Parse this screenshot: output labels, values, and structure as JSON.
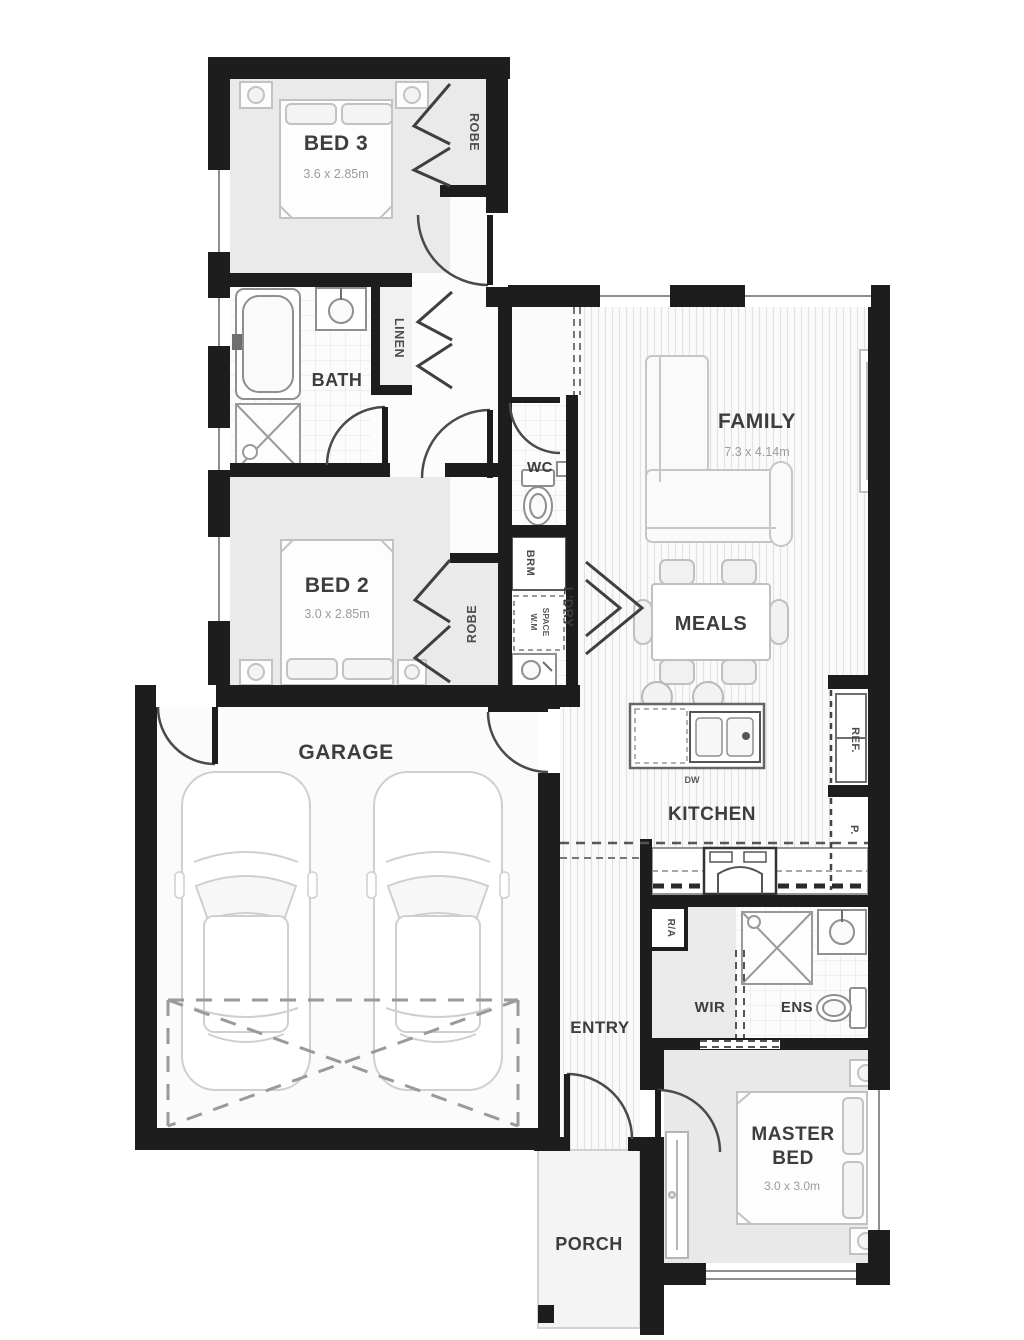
{
  "plan": {
    "rooms": {
      "bed3": {
        "name": "BED 3",
        "dims": "3.6 x 2.85m"
      },
      "bed2": {
        "name": "BED 2",
        "dims": "3.0 x 2.85m"
      },
      "master": {
        "line1": "MASTER",
        "line2": "BED",
        "dims": "3.0 x 3.0m"
      },
      "family": {
        "name": "FAMILY",
        "dims": "7.3 x 4.14m"
      },
      "meals": {
        "name": "MEALS"
      },
      "kitchen": {
        "name": "KITCHEN"
      },
      "garage": {
        "name": "GARAGE"
      },
      "bath": {
        "name": "BATH"
      },
      "wc": {
        "name": "WC"
      },
      "ldry": {
        "name": "L'DRY"
      },
      "entry": {
        "name": "ENTRY"
      },
      "porch": {
        "name": "PORCH"
      },
      "wir": {
        "name": "WIR"
      },
      "ens": {
        "name": "ENS"
      }
    },
    "storage": {
      "robe_bed3": "ROBE",
      "robe_bed2": "ROBE",
      "linen": "LINEN",
      "brm": "BRM",
      "wm_line1": "W.M",
      "wm_line2": "SPACE",
      "ref": "REF.",
      "pantry": "P."
    },
    "fixtures": {
      "dw": "DW",
      "ra": "R/A"
    },
    "colors": {
      "wall": "#1d1d1d",
      "room_fill": "#eaeaea",
      "label": "#3d3d3d",
      "dims": "#9b9b9b"
    }
  }
}
